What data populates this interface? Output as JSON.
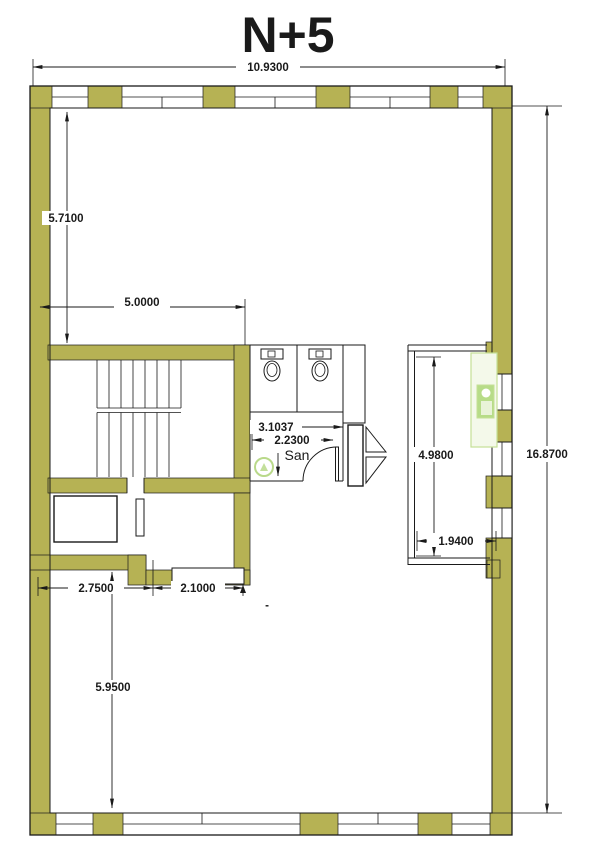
{
  "title": "N+5",
  "colors": {
    "wall": "#b6b254",
    "line": "#1a1a1a",
    "fixture_outline": "#c5e096",
    "fixture_fill": "#f4f9ea",
    "fixture_unit": "#b7dc88",
    "drain": "#b9d98a"
  },
  "labels": {
    "room": "San",
    "stray_dash": "-"
  },
  "dimensions": {
    "overall_width": "10.9300",
    "upper_left_height": "5.7100",
    "stair_room_width": "5.0000",
    "san_width": "3.1037",
    "san_door_width": "2.2300",
    "shaft_height": "4.9800",
    "overall_height": "16.8700",
    "shaft_width": "1.9400",
    "lower_left_width": "2.7500",
    "lower_mid_width": "2.1000",
    "lower_room_height": "5.9500"
  }
}
